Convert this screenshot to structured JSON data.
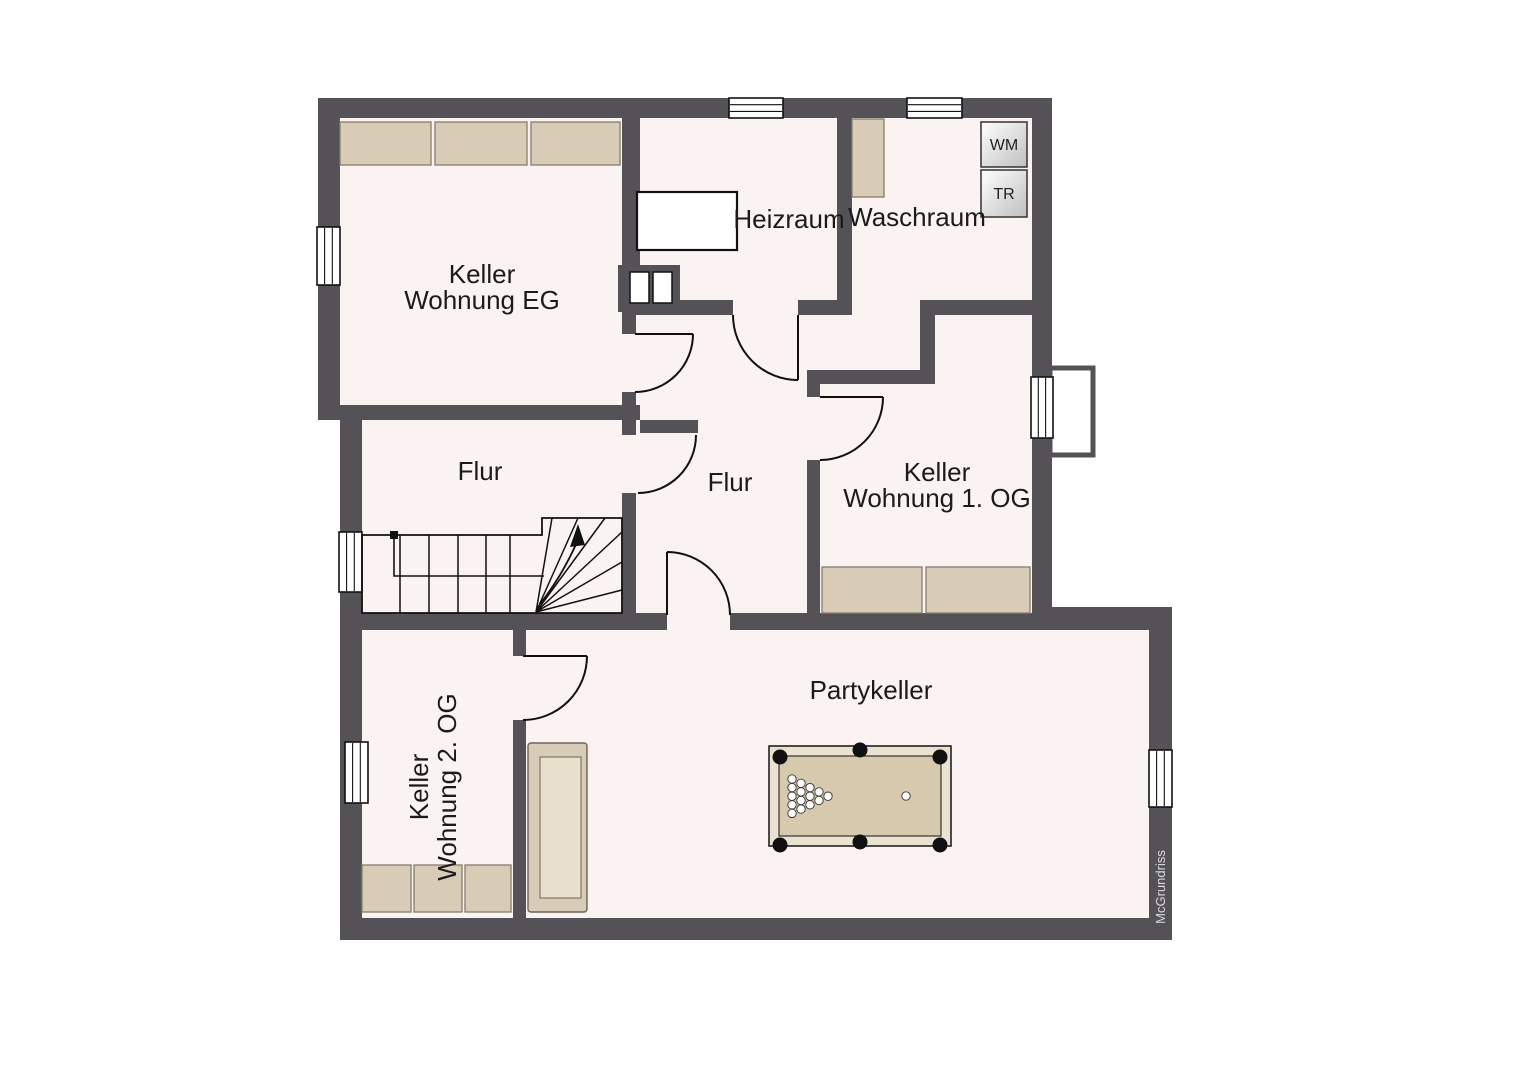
{
  "plan": {
    "watermark": "McGrundriss",
    "rooms": {
      "keller_eg": {
        "line1": "Keller",
        "line2": "Wohnung EG"
      },
      "heizraum": {
        "label": "Heizraum"
      },
      "waschraum": {
        "label": "Waschraum"
      },
      "flur_links": {
        "label": "Flur"
      },
      "flur_mitte": {
        "label": "Flur"
      },
      "keller_og1": {
        "line1": "Keller",
        "line2": "Wohnung 1. OG"
      },
      "keller_og2": {
        "line1": "Keller",
        "line2": "Wohnung 2. OG"
      },
      "partykeller": {
        "label": "Partykeller"
      }
    },
    "appliances": {
      "washing_machine": "WM",
      "dryer": "TR"
    }
  },
  "colors": {
    "background": "#ffffff",
    "wall": "#545257",
    "floor": "#faf3f1",
    "outline": "#111111",
    "furniture": "#d9ccb6",
    "furniture_border": "#847c6d",
    "sofa_seat": "#e9dfcd",
    "pool_frame": "#eae1d0",
    "pool_surface": "#d7c9ae",
    "label_text": "#1b1b1b",
    "watermark_text": "#d9d9d9"
  }
}
